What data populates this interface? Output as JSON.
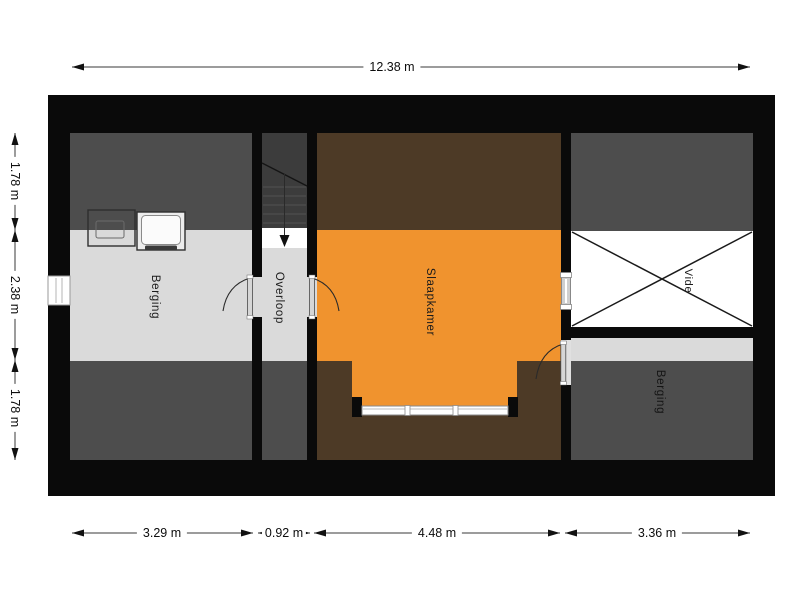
{
  "plan": {
    "type": "floor-plan-attic-level",
    "rooms": {
      "berging_left": {
        "label": "Berging"
      },
      "overloop": {
        "label": "Overloop"
      },
      "slaapkamer": {
        "label": "Slaapkamer"
      },
      "vide": {
        "label": "Vide"
      },
      "berging_right": {
        "label": "Berging"
      }
    },
    "dimensions": {
      "top_total": {
        "label": "12.38 m"
      },
      "bottom": [
        {
          "label": "3.29 m"
        },
        {
          "label": "0.92 m"
        },
        {
          "label": "4.48 m"
        },
        {
          "label": "3.36 m"
        }
      ],
      "left": [
        {
          "label": "1.78 m"
        },
        {
          "label": "2.38 m"
        },
        {
          "label": "1.78 m"
        }
      ]
    },
    "colors": {
      "wall_black": "#0a0a0a",
      "floor_light_gray": "#dadada",
      "low_ceiling_dark_gray": "#4d4d4d",
      "stairs_dark_gray": "#3c3c3c",
      "slaapkamer_floor_orange": "#f0932e",
      "slaapkamer_low_ceiling_brown": "#4d3a26",
      "vide_white": "#ffffff",
      "dim_line": "#3a3a3a"
    },
    "icons": {
      "stairs_direction": "down-arrow",
      "vide_marker": "x-cross",
      "appliance_left": "laundry-tub",
      "appliance_right": "washing-machine"
    }
  }
}
